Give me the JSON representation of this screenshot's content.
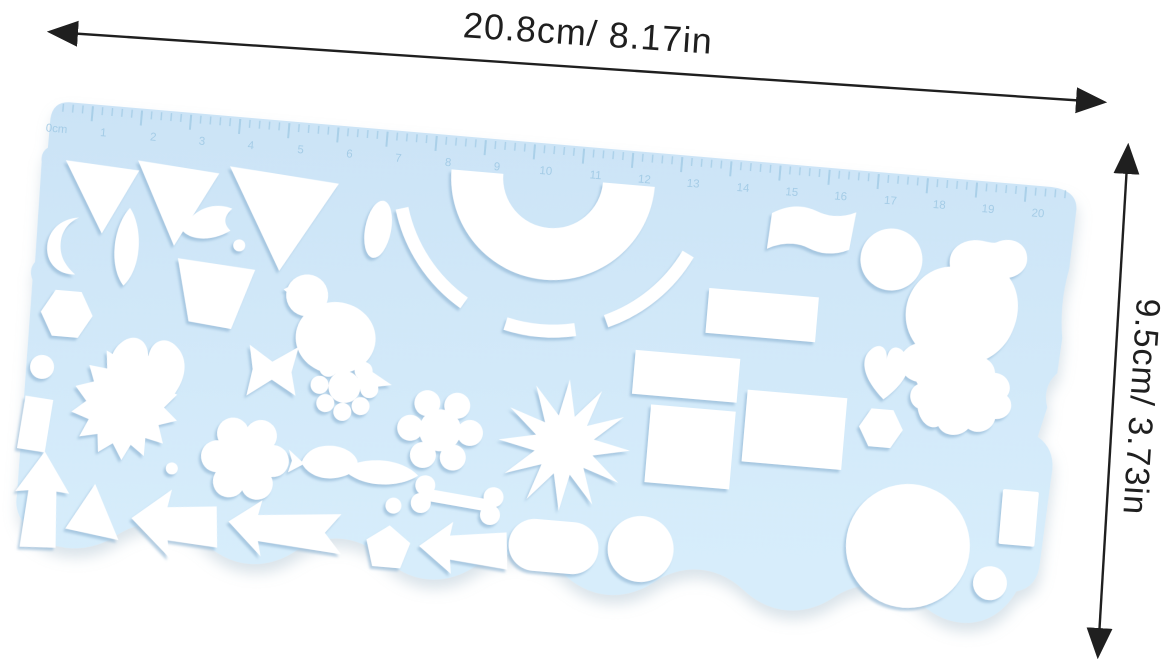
{
  "scene": {
    "background_color": "#ffffff",
    "description": "Product photo of a light blue plastic drawing stencil ruler with shape cutouts and dimension annotations"
  },
  "dimension_annotations": {
    "width_label": "20.8cm/ 8.17in",
    "height_label": "9.5cm/ 3.73in",
    "line_color": "#1f1f1f",
    "text_color": "#1f1f1f"
  },
  "stencil": {
    "body_color": "#cfe7f8",
    "body_color_light": "#d9eefb",
    "cutout_color": "#ffffff",
    "tick_color": "#8fc0de",
    "number_color": "#9ec8e4",
    "ruler": {
      "zero_label": "0cm",
      "numbers": [
        "1",
        "2",
        "3",
        "4",
        "5",
        "6",
        "7",
        "8",
        "9",
        "10",
        "11",
        "12",
        "13",
        "14",
        "15",
        "16",
        "17",
        "18",
        "19",
        "20"
      ]
    },
    "shapes": [
      "inverted-triangle-small",
      "inverted-triangle-medium",
      "inverted-triangle-large",
      "crescent-moon",
      "pointed-oval-vertical",
      "wave-swoosh",
      "dot-top",
      "trapezoid",
      "hexagon",
      "heart-large",
      "bird",
      "oval-small",
      "rainbow-half-ring",
      "dashed-outer-arc",
      "wavy-banner",
      "circle-medium-top",
      "koi-fish",
      "rectangle-wide",
      "rectangle-medium",
      "square-large",
      "square-medium",
      "heart-small",
      "hexagon-small",
      "cloud-curl",
      "rectangle-vertical-small",
      "circle-large",
      "circle-small-end",
      "capsule",
      "circle-bottom-medium",
      "arrow-left-small",
      "pentagon-small",
      "dot-mid",
      "bone",
      "pointed-oval-horizontal",
      "fish-small",
      "splat-flower",
      "starburst-sun",
      "snowflake-flower",
      "flower-8-petal",
      "bowtie",
      "i-bar",
      "dot-left",
      "arrow-up",
      "maple-leaf",
      "triangle-tiny",
      "arrow-left-large",
      "long-arrow-left",
      "dot-lower"
    ]
  }
}
